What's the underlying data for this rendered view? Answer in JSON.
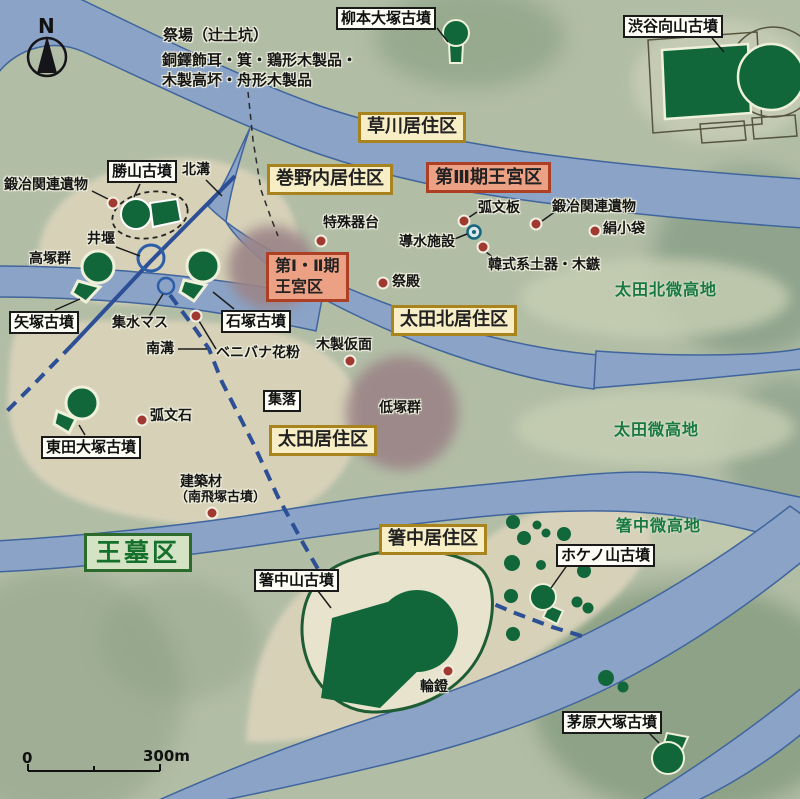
{
  "compass": {
    "north": "N"
  },
  "scale_bar": {
    "zero": "0",
    "distance": "300m"
  },
  "kofun_labels": {
    "yanagimoto_otsuka": "柳本大塚古墳",
    "shibutani_mukaiyama": "渋谷向山古墳",
    "katsuyama": "勝山古墳",
    "yazuka": "矢塚古墳",
    "ishizuka": "石塚古墳",
    "higaida_otsuka": "東田大塚古墳",
    "hashinakayama": "箸中山古墳",
    "hokenoyama": "ホケノ山古墳",
    "chihara_otsuka": "茅原大塚古墳"
  },
  "district_labels": {
    "kusakawa": "草川居住区",
    "makinouchi": "巻野内居住区",
    "phase3_palace": "第Ⅲ期王宮区",
    "phase12_palace_line1": "第Ⅰ・Ⅱ期",
    "phase12_palace_line2": "王宮区",
    "ota_north": "太田北居住区",
    "ota": "太田居住区",
    "hashinaka": "箸中居住区",
    "royal_tombs": "王墓区",
    "settlement": "集落"
  },
  "terrain_labels": {
    "ota_north_highland": "太田北微高地",
    "ota_highland": "太田微高地",
    "hashinaka_highland": "箸中微高地",
    "low_mound_group": "低塚群",
    "high_mound_group": "高塚群"
  },
  "annotations": {
    "ritual_site": "祭場（辻土坑）",
    "artifacts_line1": "銅鐸飾耳・箕・鶏形木製品・",
    "artifacts_line2": "木製高坏・舟形木製品",
    "smithing_remains_left": "鍛冶関連遺物",
    "north_ditch": "北溝",
    "south_ditch": "南溝",
    "weir": "井堰",
    "water_collecting_box": "集水マス",
    "special_vessel_stand": "特殊器台",
    "arc_patterned_board": "弧文板",
    "water_conduit_facility": "導水施設",
    "korean_style_pottery": "韓式系土器・木鏃",
    "smithing_remains_right": "鍛冶関連遺物",
    "silk_pouch": "絹小袋",
    "ritual_hall": "祭殿",
    "wooden_mask": "木製仮面",
    "safflower_pollen": "ベニバナ花粉",
    "arc_patterned_stone": "弧文石",
    "building_material_line1": "建築材",
    "building_material_line2": "（南飛塚古墳）",
    "ring_stirrup": "輪鐙"
  },
  "colors": {
    "map_background": "#b2bda6",
    "river_fill": "#8aa3c7",
    "river_edge": "#40659d",
    "kofun_green": "#116739",
    "district_box_bg": "#f7eec6",
    "district_box_border": "#a9831d",
    "palace_box_bg": "#eca184",
    "palace_box_border": "#ad3f24",
    "royal_tomb_box_bg": "#d3e3c3",
    "royal_tomb_box_border": "#2c6b2c",
    "find_spot_red": "#a03a31",
    "mauve_mound_area": "#9b8487",
    "alluvial_beige": "#d9d3ba"
  }
}
